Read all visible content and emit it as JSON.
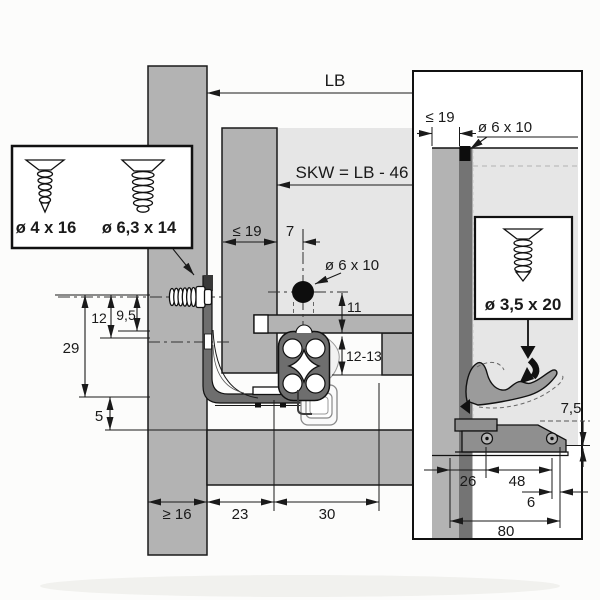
{
  "drawing_title": "drawer-runner-installation-technical-drawing",
  "colors": {
    "panel_gray": "#b3b3b3",
    "light_gray": "#e6e6e6",
    "profile_dark_gray": "#6e6e6e",
    "latch_gray": "#8f8f8f",
    "line_black": "#1a1a1a"
  },
  "screw_legend": {
    "screw1_label": "ø 4 x 16",
    "screw2_label": "ø 6,3 x 14"
  },
  "main_view": {
    "lb": "LB",
    "skw": "SKW = LB - 46",
    "panel_max": "≤ 19",
    "offset": "7",
    "hole": "ø 6 x 10",
    "d11": "11",
    "d12_13": "12-13",
    "d12": "12",
    "d9_5": "9,5",
    "d29": "29",
    "d5": "5",
    "d16": "≥ 16",
    "d23": "23",
    "d30": "30"
  },
  "side_view": {
    "panel_max": "≤ 19",
    "hole": "ø 6 x 10",
    "screw_label": "ø 3,5 x 20",
    "d7_5": "7,5",
    "d26": "26",
    "d48": "48",
    "d6": "6",
    "d80": "80"
  }
}
